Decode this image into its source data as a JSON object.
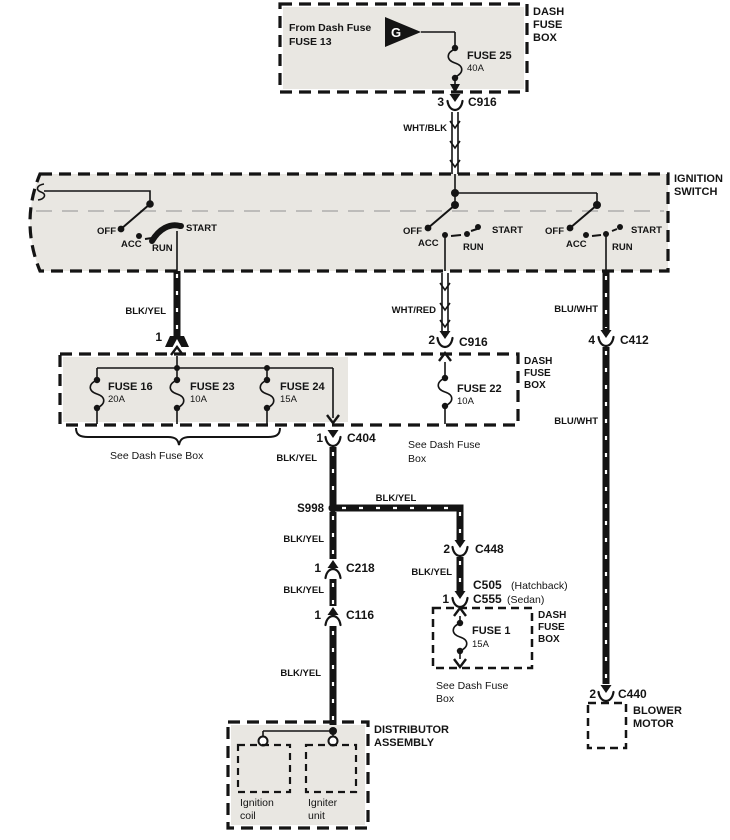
{
  "colors": {
    "ink": "#141414",
    "shade": "#e9e7e2"
  },
  "top_fuse_box": {
    "label": [
      "DASH",
      "FUSE",
      "BOX"
    ],
    "note": [
      "From Dash Fuse",
      "FUSE 13"
    ],
    "generator_symbol": "G",
    "fuse": {
      "name": "FUSE 25",
      "rating": "40A"
    }
  },
  "ignition_switch": {
    "label": [
      "IGNITION",
      "SWITCH"
    ],
    "positions": {
      "off": "OFF",
      "acc": "ACC",
      "run": "RUN",
      "start": "START"
    }
  },
  "wire_labels": {
    "wht_blk": "WHT/BLK",
    "blk_yel": "BLK/YEL",
    "wht_red": "WHT/RED",
    "blu_wht": "BLU/WHT"
  },
  "main_fuse_box": {
    "label": [
      "DASH",
      "FUSE",
      "BOX"
    ],
    "entry_pin": "1",
    "fuses": [
      {
        "name": "FUSE 16",
        "rating": "20A"
      },
      {
        "name": "FUSE 23",
        "rating": "10A"
      },
      {
        "name": "FUSE 24",
        "rating": "15A"
      },
      {
        "name": "FUSE 22",
        "rating": "10A"
      }
    ],
    "see_note": "See Dash Fuse Box",
    "see_note_wrapped": [
      "See Dash Fuse",
      "Box"
    ]
  },
  "connectors": {
    "c916_top": {
      "pin": "3",
      "name": "C916"
    },
    "c916_mid": {
      "pin": "2",
      "name": "C916"
    },
    "c412": {
      "pin": "4",
      "name": "C412"
    },
    "c404": {
      "pin": "1",
      "name": "C404"
    },
    "c448": {
      "pin": "2",
      "name": "C448"
    },
    "c505": {
      "name": "C505",
      "variant": "(Hatchback)"
    },
    "c555": {
      "pin": "1",
      "name": "C555",
      "variant": "(Sedan)"
    },
    "c218": {
      "pin": "1",
      "name": "C218"
    },
    "c116": {
      "pin": "1",
      "name": "C116"
    },
    "c440": {
      "pin": "2",
      "name": "C440"
    }
  },
  "splice": {
    "name": "S998"
  },
  "fuse1_box": {
    "label": [
      "DASH",
      "FUSE",
      "BOX"
    ],
    "fuse": {
      "name": "FUSE 1",
      "rating": "15A"
    },
    "see_note": [
      "See Dash Fuse",
      "Box"
    ]
  },
  "distributor": {
    "label": [
      "DISTRIBUTOR",
      "ASSEMBLY"
    ],
    "ignition_coil": [
      "Ignition",
      "coil"
    ],
    "igniter_unit": [
      "Igniter",
      "unit"
    ]
  },
  "blower": {
    "label": [
      "BLOWER",
      "MOTOR"
    ]
  }
}
